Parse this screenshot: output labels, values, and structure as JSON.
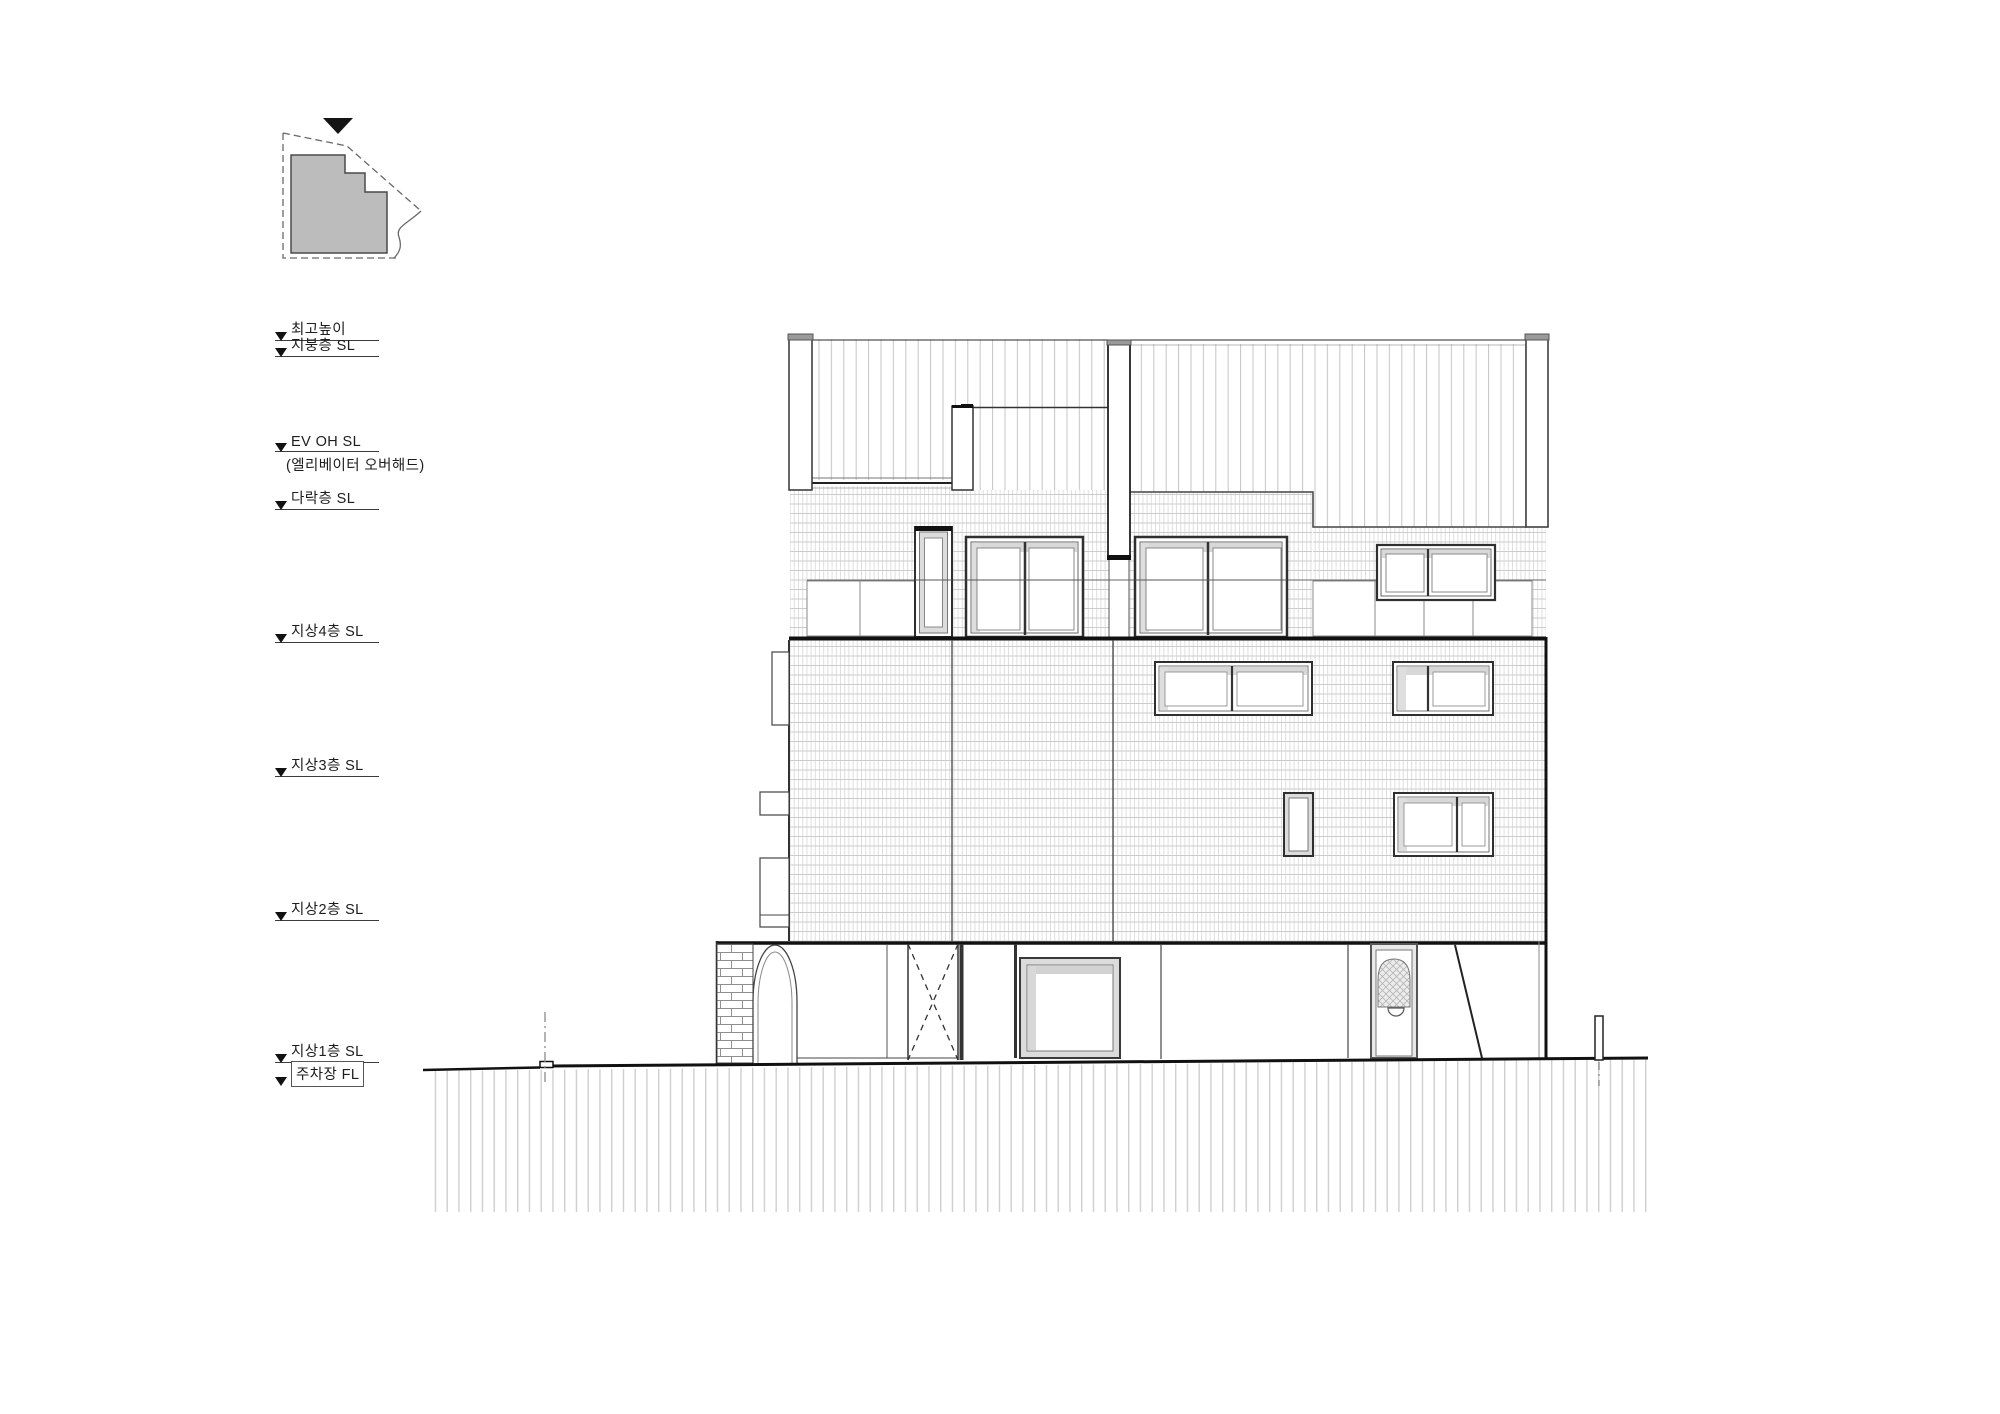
{
  "sheet": {
    "type": "architectural-elevation-drawing",
    "background": "#ffffff",
    "language": "ko"
  },
  "key_plan": {
    "name": "key plan",
    "north_marker_icon": "filled-down-triangle",
    "site_boundary_style": "dashed",
    "footprint_fill": "#bcbcbc"
  },
  "levels": [
    {
      "id": "max-height",
      "label": "최고높이",
      "y": 341
    },
    {
      "id": "roof-sl",
      "label": "지붕층  SL",
      "y": 357
    },
    {
      "id": "ev-oh-sl",
      "label": "EV OH SL",
      "y": 452,
      "sub": "(엘리베이터 오버해드)"
    },
    {
      "id": "attic-sl",
      "label": "다락층  SL",
      "y": 510
    },
    {
      "id": "f4-sl",
      "label": "지상4층 SL",
      "y": 643
    },
    {
      "id": "f3-sl",
      "label": "지상3층 SL",
      "y": 777
    },
    {
      "id": "f2-sl",
      "label": "지상2층 SL",
      "y": 921
    },
    {
      "id": "f1-sl",
      "label": "지상1층 SL",
      "y": 1063
    },
    {
      "id": "parking-fl",
      "label": "주차장 FL",
      "y": 1086,
      "boxed": true,
      "noline": true
    }
  ],
  "colors": {
    "line": "#1c1c1c",
    "roof_seam_hatch": "#c4c4c4",
    "brick_hatch_v": "#dadada",
    "brick_hatch_h": "#c8c8c8",
    "ground_hatch": "#cfcfcf",
    "keyplan_fill": "#bcbcbc",
    "post_cap": "#9a9a9a",
    "window_shadow": "#d8d8d8"
  }
}
